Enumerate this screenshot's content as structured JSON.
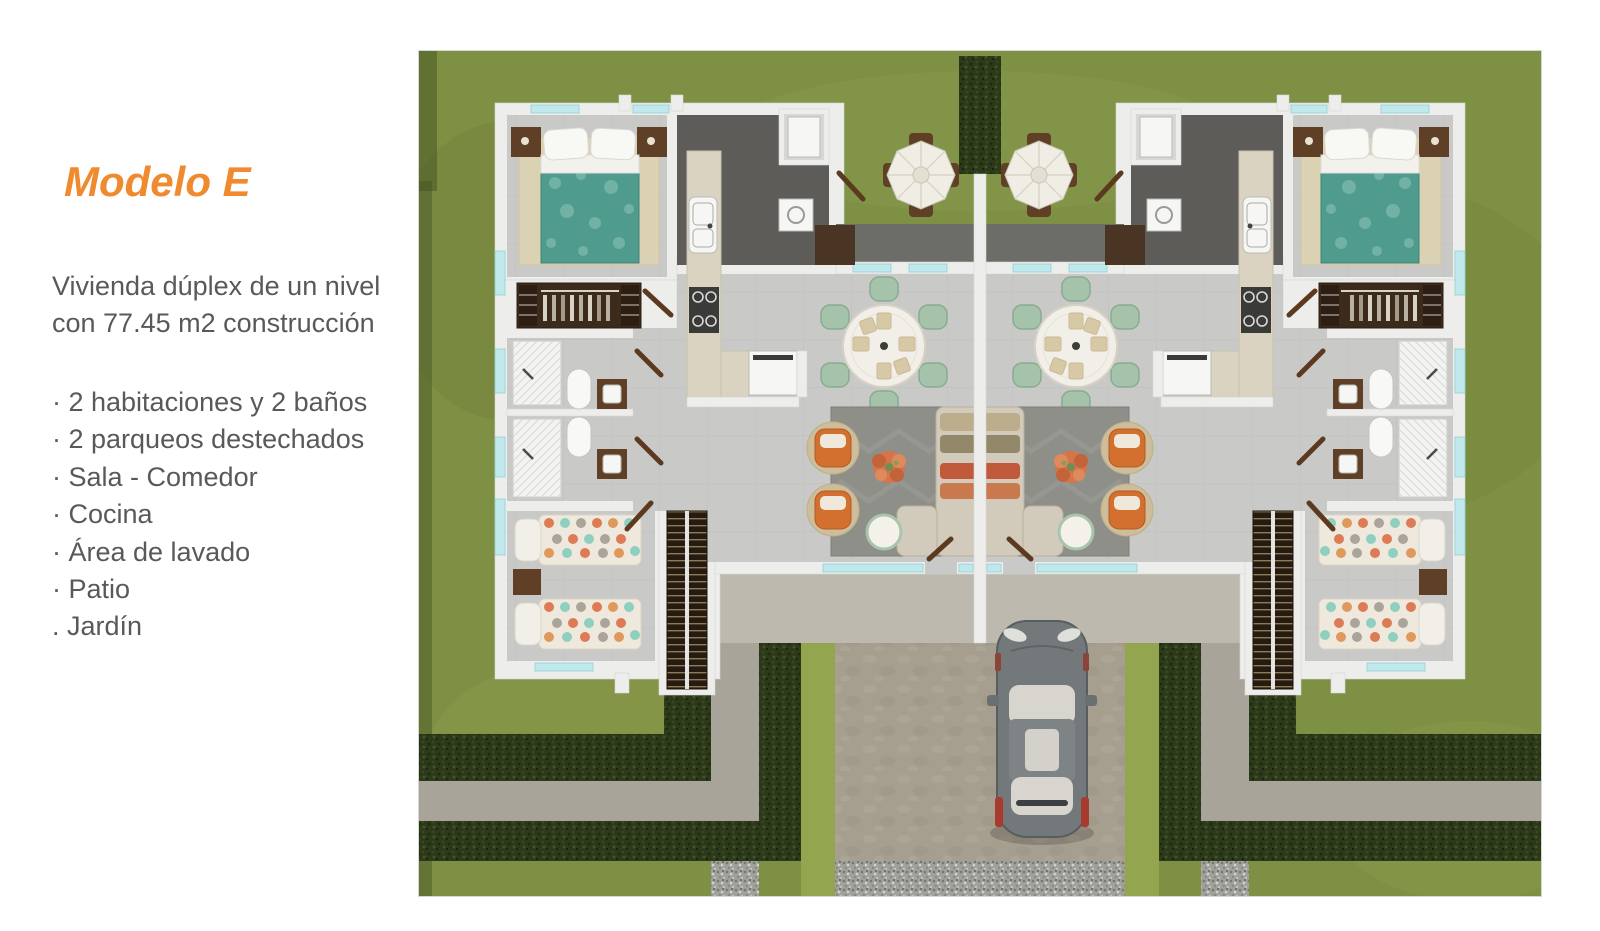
{
  "panel": {
    "title": "Modelo E",
    "title_color": "#F08A2E",
    "description_line1": "Vivienda dúplex de un nivel",
    "description_line2": "con 77.45 m2 construcción",
    "features": [
      "· 2 habitaciones y 2 baños",
      "· 2 parqueos destechados",
      "· Sala - Comedor",
      "· Cocina",
      "· Área de lavado",
      "· Patio",
      ". Jardín"
    ],
    "text_color": "#58595A"
  },
  "floor_plan": {
    "kind": "top-down 3D render of one-level duplex, two mirrored units",
    "units": 2,
    "rooms_per_unit": [
      "bedroom-master",
      "closet",
      "bathroom-1",
      "bathroom-2",
      "bedroom-2",
      "kitchen",
      "dining",
      "living",
      "laundry",
      "terrace",
      "patio"
    ],
    "exterior": [
      "grass",
      "hedges",
      "walkways",
      "driveway",
      "gravel-strip",
      "patio-umbrella-tables",
      "parked-car"
    ],
    "colors": {
      "grass": "#7e9044",
      "hedge": "#2d3a1a",
      "walkway": "#a8a49a",
      "driveway": "#a69f90",
      "gravel": "#a0a09c",
      "wall": "#ededeb",
      "floor_tile": "#c9c9c7",
      "utility_floor": "#5d5c58",
      "terrace": "#6d6d67",
      "kitchen_counter": "#dad3c2",
      "bed_duvet_teal": "#4f9b8e",
      "accent_chair_orange": "#d4702f",
      "dining_chair_green": "#a5c3aa",
      "car_body_gray": "#73787a",
      "wood_brown": "#5f3f26"
    }
  }
}
